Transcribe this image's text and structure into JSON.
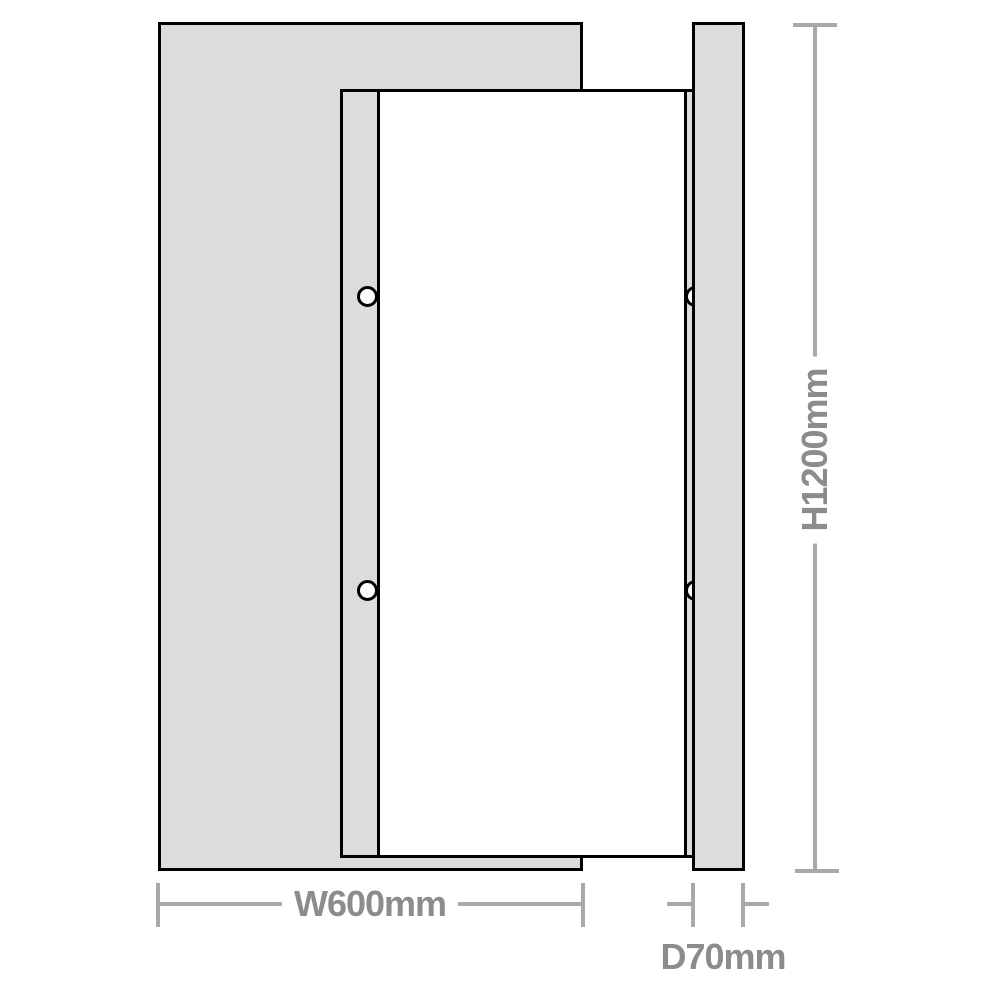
{
  "diagram": {
    "type": "product-dimension-drawing",
    "views": {
      "front": {
        "name": "front elevation",
        "mounting_holes": {
          "count": 4,
          "shape": "circle"
        }
      },
      "side": {
        "name": "side profile"
      }
    },
    "dimensions": {
      "width": {
        "label": "W600mm",
        "value_mm": 600,
        "axis": "horizontal"
      },
      "height": {
        "label": "H1200mm",
        "value_mm": 1200,
        "axis": "vertical"
      },
      "depth": {
        "label": "D70mm",
        "value_mm": 70,
        "axis": "horizontal"
      }
    },
    "colors": {
      "frame_fill": "#dcdcdc",
      "outline": "#000000",
      "dim_line": "#a9a9a9",
      "dim_text": "#8c8c8c",
      "hole_fill": "#ffffff",
      "bg": "#ffffff"
    }
  }
}
